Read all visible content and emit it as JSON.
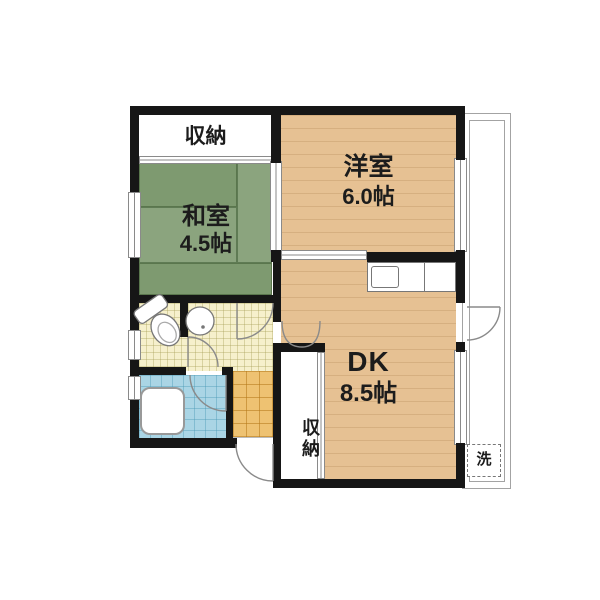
{
  "rooms": {
    "closet_top": {
      "label": "収納"
    },
    "japanese_room": {
      "label": "和室",
      "size": "4.5帖"
    },
    "western_room": {
      "label": "洋室",
      "size": "6.0帖"
    },
    "dining_kitchen": {
      "label": "DK",
      "size": "8.5帖"
    },
    "closet_bottom": {
      "label": "収納"
    },
    "laundry_space": {
      "label": "洗"
    }
  },
  "colors": {
    "wall": "#161616",
    "wood_floor": "#e6c193",
    "tatami_dark": "#7e9a70",
    "tatami_light": "#8ba47e",
    "washroom_tile": "#f6f0cc",
    "entry_tile": "#eec272",
    "bath_tile": "#aad5e5"
  }
}
